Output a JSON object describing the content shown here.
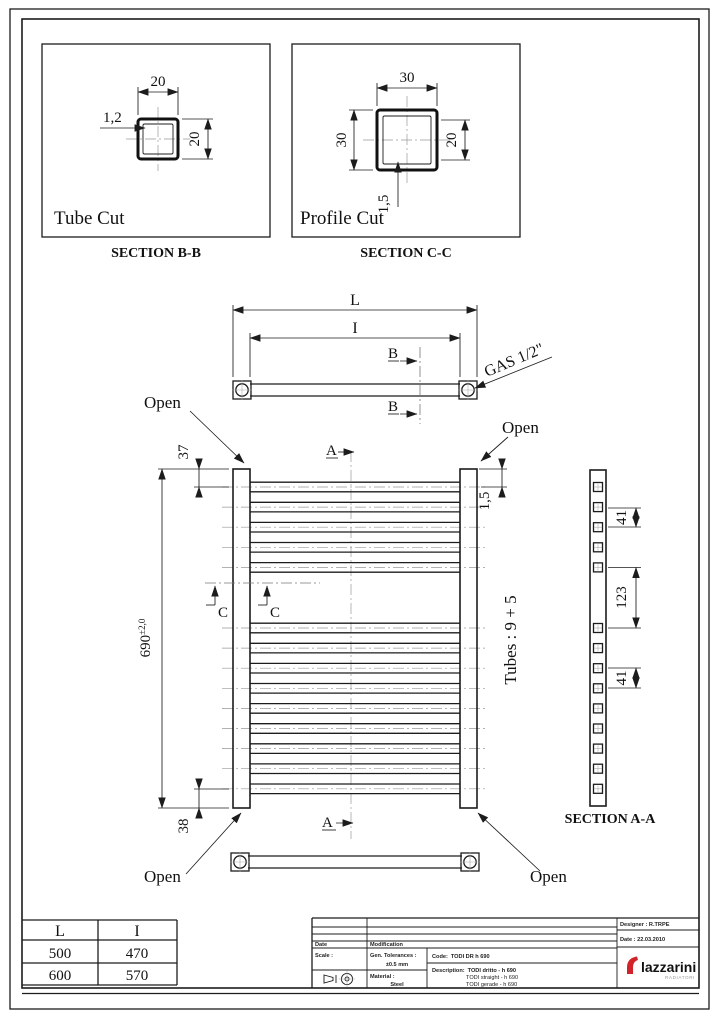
{
  "tube_cut": {
    "label": "Tube Cut",
    "caption": "SECTION B-B",
    "dim_width": "20",
    "dim_height": "20",
    "dim_wall": "1,2"
  },
  "profile_cut": {
    "label": "Profile Cut",
    "caption": "SECTION C-C",
    "dim_width": "30",
    "dim_height": "30",
    "dim_inner": "20",
    "dim_wall": "1,5"
  },
  "section_aa": {
    "caption": "SECTION A-A",
    "dim_pitch_top": "41",
    "dim_gap": "123",
    "dim_pitch_bottom": "41"
  },
  "main_drawing": {
    "dim_L": "L",
    "dim_I": "I",
    "gas_label": "GAS 1/2\"",
    "open_label": "Open",
    "dim_height": "690",
    "dim_height_tol": "±2,0",
    "dim_top": "37",
    "dim_bottom": "38",
    "dim_wall": "1,5",
    "tubes_label": "Tubes : 9 + 5",
    "marker_a": "A",
    "marker_b": "B",
    "marker_c": "C",
    "tubes": {
      "top": 5,
      "bottom": 9
    }
  },
  "size_table": {
    "headers": [
      "L",
      "I"
    ],
    "rows": [
      [
        "500",
        "470"
      ],
      [
        "600",
        "570"
      ]
    ]
  },
  "title_block": {
    "date_label": "Date",
    "modification_label": "Modification",
    "scale_label": "Scale :",
    "tolerances_label": "Gen. Tolerances :",
    "tolerances_value": "±0.5 mm",
    "material_label": "Material :",
    "material_value": "Steel",
    "code_label": "Code:",
    "code_value": "TODI DR h 690",
    "description_label": "Description:",
    "description_line1": "TODI dritto - h 690",
    "description_line2": "TODI straight - h 690",
    "description_line3": "TODI gerade - h 690",
    "designer": "Designer : R.TRPE",
    "date": "Date : 22.03.2010",
    "logo_text": "lazzarini",
    "logo_subtext": "RADIATORI",
    "logo_color": "#d2232a"
  }
}
